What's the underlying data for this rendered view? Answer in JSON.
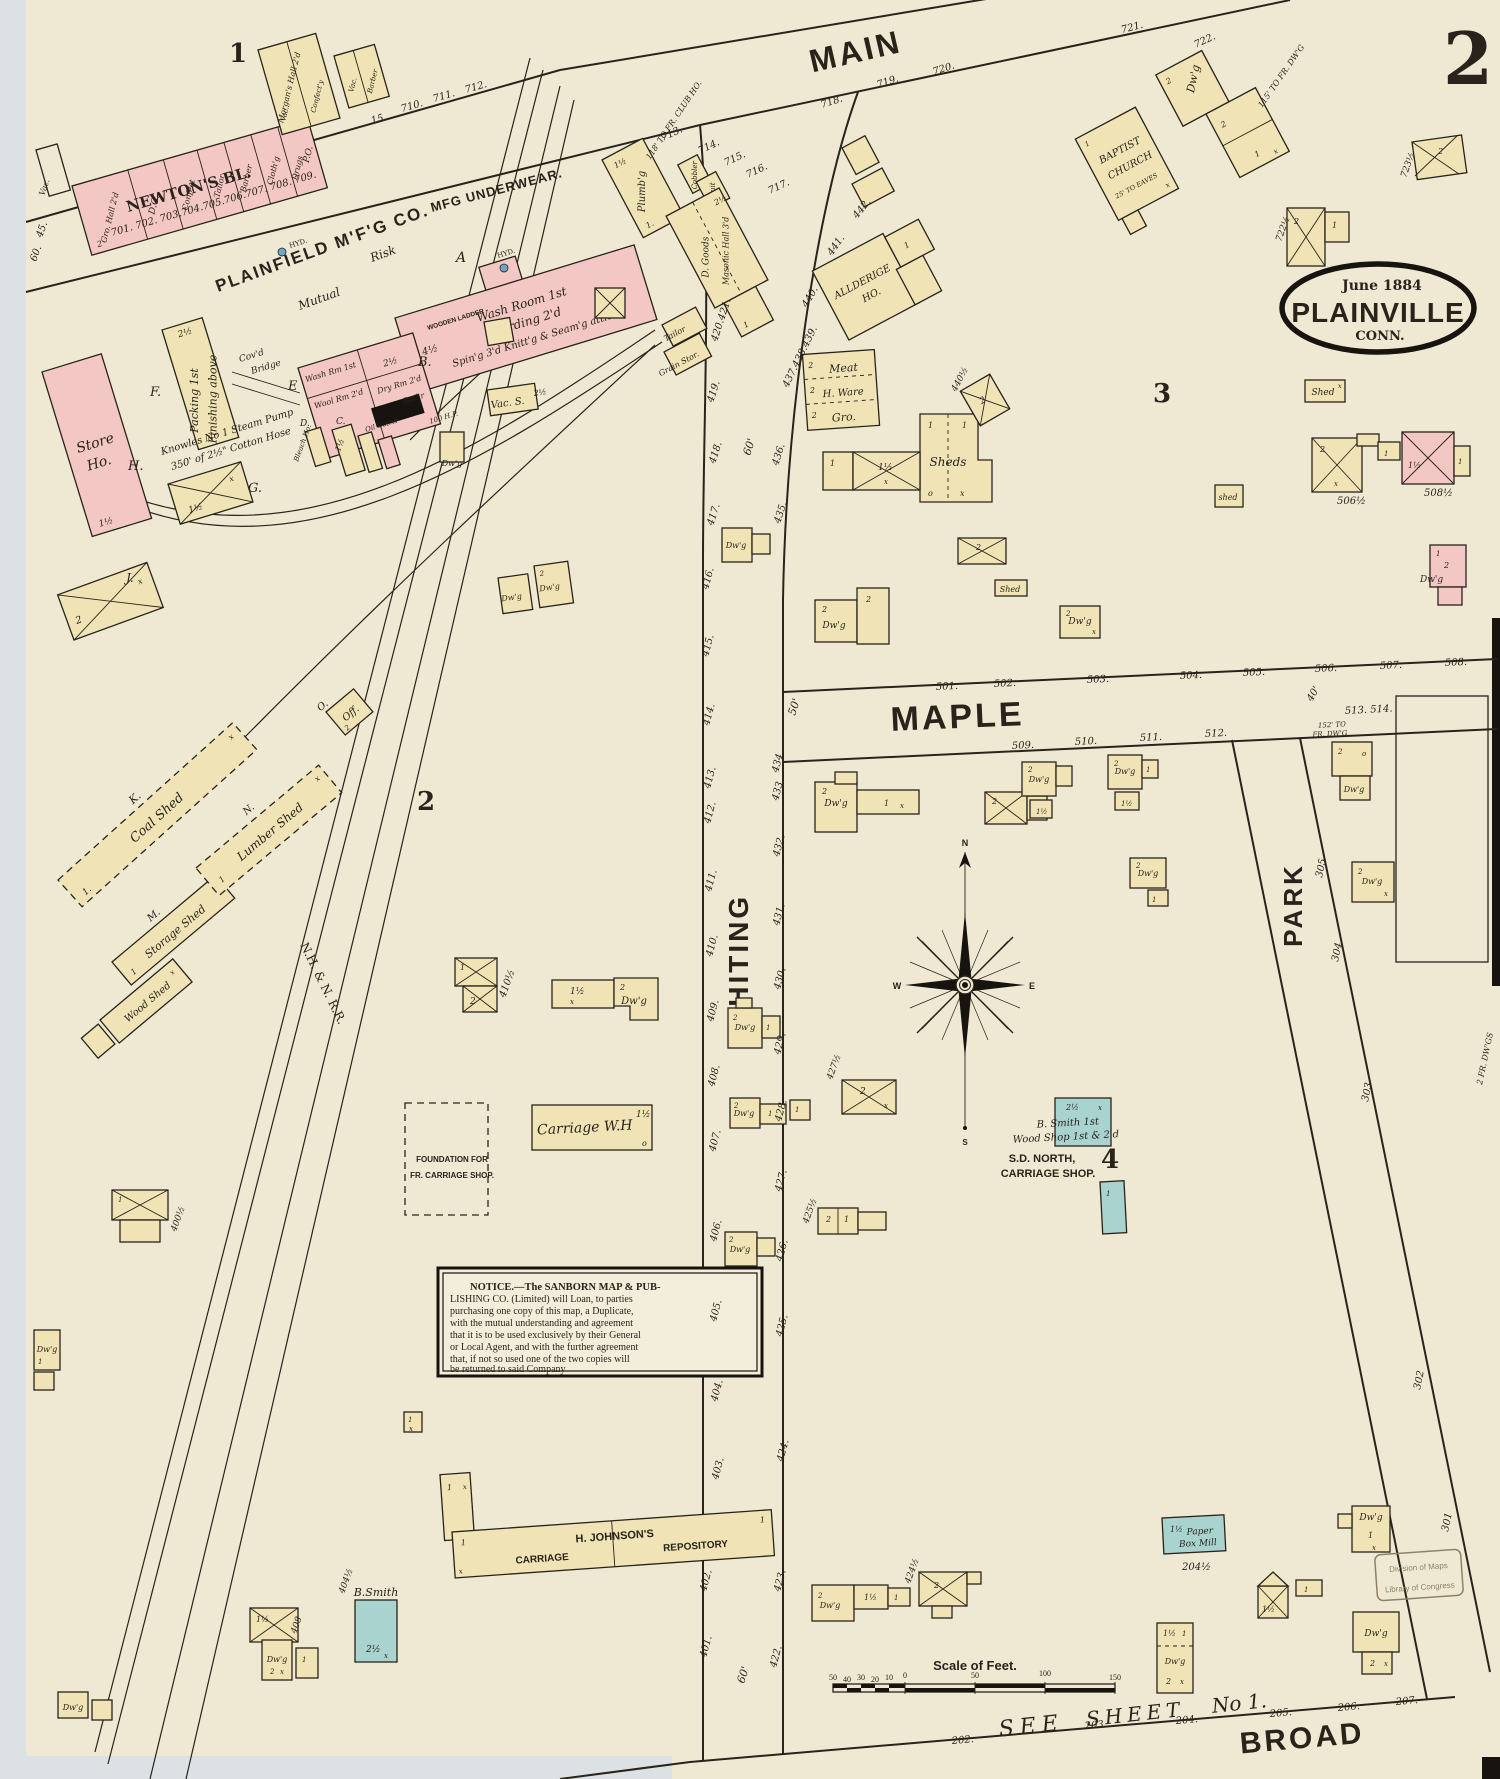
{
  "page": {
    "sheet_number": "2"
  },
  "title": {
    "date": "June 1884",
    "city": "PLAINVILLE",
    "state": "CONN."
  },
  "streets": {
    "main": "MAIN",
    "maple": "MAPLE",
    "whiting": "WHITING",
    "park": "PARK",
    "broad": "BROAD",
    "railroad": "N.H. & N. R.R.",
    "see": "SEE",
    "sheet": "SHEET",
    "no1": "No 1."
  },
  "widths": {
    "w50": "50'",
    "w60": "60'",
    "w40": "40'",
    "w45": "45.",
    "w60b": "60."
  },
  "blocks": {
    "b1": "1",
    "b2": "2",
    "b3": "3",
    "b4": "4"
  },
  "marks": {
    "dwg": "Dw'g",
    "x": "x",
    "o": "o",
    "n1": "1",
    "n1d": "1.",
    "n2": "2",
    "n1h": "1½",
    "n2h": "2½",
    "n4h": "4½",
    "vac": "Vac.",
    "vacs": "Vac. S.",
    "shed": "Shed",
    "sheds": "Sheds",
    "shedlc": "shed",
    "hyd": "HYD."
  },
  "newton": {
    "name": "NEWTON'S BL.",
    "s0": "Gro. Hall 2'd",
    "s1": "D.G.",
    "s2": "Confect",
    "s3": "Tailor",
    "s4": "Barber",
    "s5": "Cloth'g",
    "s6": "Drugs",
    "s7": "P.O.",
    "numbers": "701. 702. 703.704.705.706.707. 708. 709.",
    "x15": "15",
    "x710": "710.",
    "x711": "711.",
    "x712": "712."
  },
  "morgan": {
    "name": "Morgan's Hall 2'd",
    "confect": "Confect'y",
    "barber": "Barber"
  },
  "mill": {
    "title": "PLAINFIELD M'F'G CO.",
    "mutual": "Mutual",
    "risk": "Risk",
    "underwear": "MFG UNDERWEAR.",
    "a1": "Wash Room 1st",
    "a2": "Carding 2'd",
    "a3": "Spin'g 3'd Knitt'g & Seam'g attic",
    "wash": "Wash Rm 1st",
    "wool": "Wool Rm 2'd",
    "dry": "Dry Rm 2'd",
    "hp": "100 H.P.",
    "boiler": "Boil'r",
    "oil": "Oil Casks",
    "bleach": "Bleach Ho.",
    "packing": "Packing 1st",
    "finishing": "Finishing above",
    "store1": "Store",
    "store2": "Ho.",
    "bridge1": "Cov'd",
    "bridge2": "Bridge",
    "ladder": "WOODEN LADDER",
    "pump1": "Knowles No 1 Steam Pump",
    "pump2": "350' of 2½\" Cotton Hose",
    "la": "A",
    "lb": "B.",
    "lc": "C.",
    "ld": "D.",
    "le": "E",
    "lf": "F.",
    "lg": "G.",
    "lh": "H.",
    "lj": "J.",
    "lk": "K.",
    "lm": "M.",
    "ln": "N.",
    "lo": "O."
  },
  "sheds": {
    "coal": "Coal Shed",
    "storage": "Storage Shed",
    "lumber": "Lumber Shed",
    "office": "Off.",
    "wood": "Wood Shed"
  },
  "maintop": {
    "plumbg": "Plumb'g",
    "cobbler": "Cobbler",
    "fruit": "Fruit",
    "dgoods": "D. Goods",
    "masonic": "Masonic Hall 3'd",
    "tailor": "Tailor",
    "grain": "Grain Stor.",
    "club": "118' TO FR. CLUB HO.",
    "frdwg": "115' TO FR. DW'G",
    "n713": "713.",
    "n714": "714.",
    "n715": "715.",
    "n716": "716.",
    "n717": "717.",
    "n718": "718.",
    "n719": "719.",
    "n720": "720.",
    "n721": "721.",
    "n722": "722."
  },
  "block3": {
    "all1": "ALLDERIGE",
    "all2": "HO.",
    "ch1": "BAPTIST",
    "ch2": "CHURCH",
    "eaves": "25' TO EAVES",
    "meat": "Meat",
    "hware": "H. Ware",
    "gro": "Gro.",
    "n440h": "440½",
    "n506h": "506½",
    "n508h": "508½",
    "n722h": "722½",
    "n723h": "723½"
  },
  "block4": {
    "smith1": "B. Smith 1st",
    "smith2": "Wood Shop 1st & 2'd",
    "north1": "S.D. NORTH,",
    "north2": "CARRIAGE SHOP.",
    "cwh": "Carriage W.H",
    "found1": "FOUNDATION FOR",
    "found2": "FR. CARRIAGE SHOP.",
    "j1": "H. JOHNSON'S",
    "j2": "CARRIAGE",
    "j3": "REPOSITORY",
    "bsmith": "B.Smith",
    "paper1": "Paper",
    "paper2": "Box Mill",
    "frdwgs": "2 FR. DW'GS",
    "n427h": "427½",
    "n425h": "425½",
    "n424h": "424½",
    "n410h": "410½",
    "n400h": "400½",
    "n404h": "404½",
    "n408": "408",
    "n204h": "204½"
  },
  "nums": {
    "ww": [
      "416.",
      "415.",
      "414.",
      "413.",
      "412.",
      "411.",
      "410.",
      "409.",
      "408.",
      "407.",
      "406.",
      "405.",
      "404.",
      "403.",
      "402.",
      "401."
    ],
    "we": [
      "434.",
      "433.",
      "432.",
      "431.",
      "430.",
      "429.",
      "428.",
      "427.",
      "426.",
      "425.",
      "424.",
      "423.",
      "422."
    ],
    "cw": [
      "417.",
      "418.",
      "419.",
      "420.421."
    ],
    "ce": [
      "435.",
      "436.",
      "437.438.439.",
      "440.",
      "441.",
      "442."
    ],
    "mn": [
      "501.",
      "502.",
      "503.",
      "504.",
      "505.",
      "506.",
      "507.",
      "508."
    ],
    "ms": [
      "509.",
      "510.",
      "511.",
      "512."
    ],
    "me": "513. 514.",
    "park": [
      "305",
      "304",
      "303",
      "302",
      "301"
    ],
    "broad": [
      "202.",
      "203.",
      "204.",
      "205.",
      "206.",
      "207."
    ],
    "fr152a": "152' TO",
    "fr152b": "FR. DW'G"
  },
  "notice": {
    "l1": "NOTICE.—The SANBORN MAP & PUB-",
    "l2": "LISHING CO. (Limited) will Loan, to parties",
    "l3": "purchasing one copy of this map, a Duplicate,",
    "l4": "with the mutual understanding and agreement",
    "l5": "that it is to be used exclusively by their General",
    "l6": "or Local Agent, and with the further agreement",
    "l7": "that, if not so used one of the two copies will",
    "l8": "be returned to said Company"
  },
  "scale": {
    "title": "Scale of Feet.",
    "t50": "50",
    "t40": "40",
    "t30": "30",
    "t20": "20",
    "t10": "10",
    "t0": "0",
    "r50": "50",
    "r100": "100",
    "r150": "150"
  },
  "stamp": {
    "l1": "Division of Maps",
    "l2": "Library of Congress"
  },
  "compass": {
    "n": "N",
    "s": "S",
    "e": "E",
    "w": "W"
  }
}
